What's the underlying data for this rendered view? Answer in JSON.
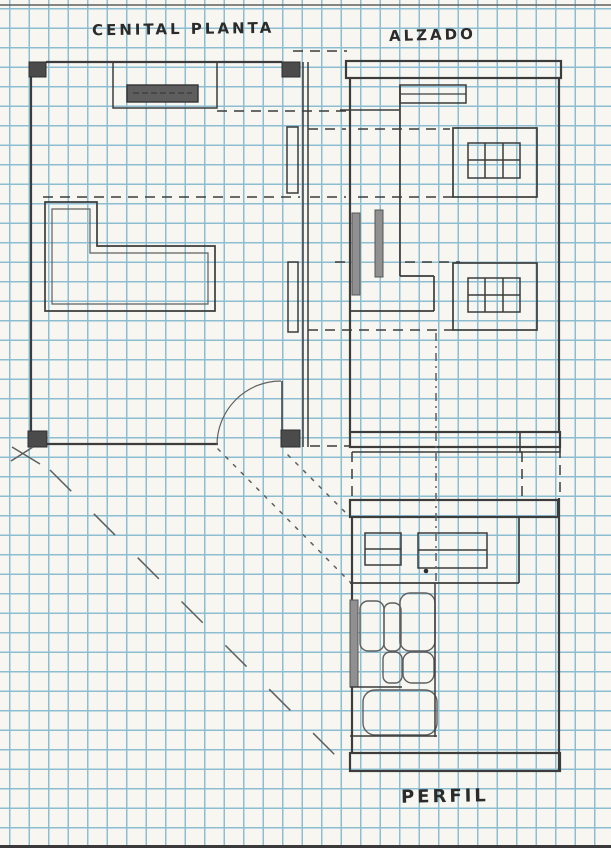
{
  "document": {
    "kind": "hand-drawn orthographic architecture sketch on graph paper",
    "labels": {
      "plan": "CENITAL PLANTA",
      "elevation": "ALZADO",
      "profile": "PERFIL"
    }
  },
  "colors": {
    "paper": "#f7f6f1",
    "grid": "#8cbdd1",
    "pencil_dark": "#3c3c3c",
    "pencil_mid": "#5f5f5f",
    "pencil_light": "#8c8c8c",
    "fill_dark": "#4b4b4b",
    "post_gray": "#909090",
    "hatch_bg": "#c9c5be",
    "hatch_stroke": "#6a6a6a",
    "edge_dark": "#3a3a3a"
  }
}
